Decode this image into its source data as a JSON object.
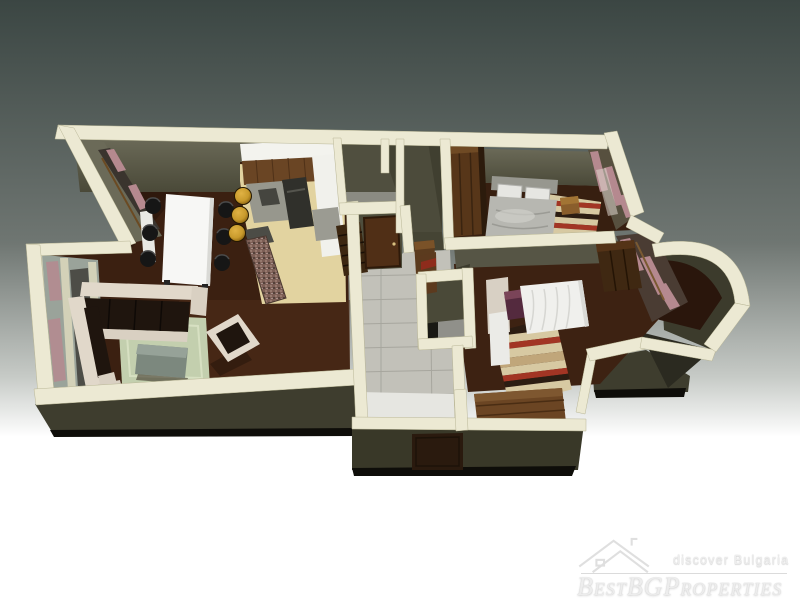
{
  "watermark": {
    "tagline": "discover Bulgaria",
    "brand": "BestBGProperties"
  },
  "colors": {
    "bg-top": "#3b4643",
    "bg-mid": "#6f7672",
    "bg-bottom": "#ffffff",
    "wall-top": "#ece9d3",
    "wall-face-dark": "#3e3d2e",
    "olive-light": "#6b6a58",
    "olive": "#565545",
    "olive-dark": "#4a4938",
    "wood-dark": "#2a160c",
    "wood": "#3b2011",
    "wood-light": "#55301a",
    "kitchen-tile": "#e2d3a0",
    "corridor-tile": "#c2c1b9",
    "entry-tile": "#e6e6e1",
    "sofa-cream": "#e1d8ca",
    "cushion-dark": "#1f150e",
    "rug-green": "#c3cfae",
    "table-white": "#f7f7f5",
    "chair-black": "#161616",
    "stool-gold": "#c89a2c",
    "mosaic-stone": "#7d5f56",
    "curtain-pink": "#b5898f",
    "glass": "#9aa39a",
    "bed-gray": "#b7b7b1",
    "bed-white": "#f0f0ed",
    "pillow-purple": "#542a3e",
    "rug-cream": "#d7c9a2",
    "rug-red": "#a23524",
    "rug-stripe-dark": "#2c1d12",
    "door-brown": "#502f16",
    "wardrobe-brown": "#573619",
    "dresser-brown": "#6b4523",
    "watermark": "#ededed"
  }
}
